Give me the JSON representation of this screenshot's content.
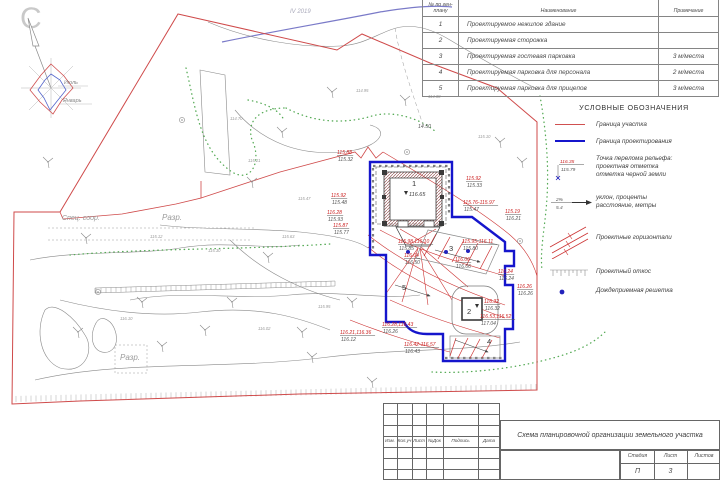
{
  "compass": {
    "north": "С",
    "july": "Июль",
    "january": "Январь"
  },
  "survey_note": "IV 2019",
  "table": {
    "headers": {
      "num": "№ по ген-плану",
      "name": "Наименование",
      "note": "Примечание"
    },
    "rows": [
      {
        "num": "1",
        "name": "Проектируемое нежилое здание",
        "note": ""
      },
      {
        "num": "2",
        "name": "Проектируемая сторожка",
        "note": ""
      },
      {
        "num": "3",
        "name": "Проектируемая гостевая парковка",
        "note": "3 м/места"
      },
      {
        "num": "4",
        "name": "Проектируемая парковка для персонала",
        "note": "2 м/места"
      },
      {
        "num": "5",
        "name": "Проектируемая парковка для прицепов",
        "note": "3 м/места"
      }
    ]
  },
  "legend": {
    "title": "УСЛОВНЫЕ ОБОЗНАЧЕНИЯ",
    "item1": "Граница участка",
    "item2": "Граница проектирования",
    "item3a": "Точка перелома рельефа:",
    "item3b": "проектная отметка",
    "item3c": "отметка черной земли",
    "item3red": "116.35",
    "item3black": "115.79",
    "item4a": "уклон, проценты",
    "item4b": "расстояние, метры",
    "item4top": "2%",
    "item4bottom": "5.4",
    "item5": "Проектные горизонтали",
    "item6": "Проектный откос",
    "item7": "Дождеприемная решетка"
  },
  "titleblock": {
    "title": "Схема планировочной организации земельного участка",
    "cols": [
      "Изм.",
      "Кол.уч",
      "Лист",
      "№Док",
      "Подпись",
      "Дата"
    ],
    "stage_label": "Стадия",
    "sheet_label": "Лист",
    "sheets_label": "Листов",
    "stage": "П",
    "sheet": "3",
    "sheets": ""
  },
  "plan": {
    "building1": {
      "num": "1",
      "elev": "116.65"
    },
    "building2": {
      "num": "2"
    },
    "spec_soor": "Спец. соор.",
    "razr1": "Разр.",
    "razr2": "Разр.",
    "dim_note": "14.50",
    "areas": [
      {
        "n": "1",
        "x": 412,
        "y": 186
      },
      {
        "n": "2",
        "x": 467,
        "y": 314
      },
      {
        "n": "3",
        "x": 449,
        "y": 251
      },
      {
        "n": "4",
        "x": 487,
        "y": 344
      },
      {
        "n": "5",
        "x": 402,
        "y": 290
      }
    ],
    "marks": [
      {
        "x": 337,
        "y": 154,
        "r": "115.88",
        "b": "115.32"
      },
      {
        "x": 331,
        "y": 197,
        "r": "115.92",
        "b": "115.48"
      },
      {
        "x": 327,
        "y": 214,
        "r": "116.28",
        "b": "115.93"
      },
      {
        "x": 333,
        "y": 227,
        "r": "115.87",
        "b": "115.77"
      },
      {
        "x": 466,
        "y": 180,
        "r": "115.92",
        "b": "115.33"
      },
      {
        "x": 463,
        "y": 204,
        "r": "115.76-115.97",
        "b": "115.47"
      },
      {
        "x": 505,
        "y": 213,
        "r": "115.19",
        "b": "116.21"
      },
      {
        "x": 462,
        "y": 243,
        "r": "115.95-116.11",
        "b": "115.80"
      },
      {
        "x": 455,
        "y": 261,
        "r": "116.06",
        "b": "116.06"
      },
      {
        "x": 498,
        "y": 273,
        "r": "116.24",
        "b": "116.24"
      },
      {
        "x": 517,
        "y": 288,
        "r": "116.26",
        "b": "116.26"
      },
      {
        "x": 484,
        "y": 303,
        "r": "116.32",
        "b": "116.32"
      },
      {
        "x": 480,
        "y": 318,
        "r": "116.53,116.52",
        "b": "117.04"
      },
      {
        "x": 398,
        "y": 243,
        "r": "115.98,116.10",
        "b": "115.85"
      },
      {
        "x": 404,
        "y": 257,
        "r": "116.04",
        "b": "116.50"
      },
      {
        "x": 382,
        "y": 326,
        "r": "116.28,116.43",
        "b": "116.26"
      },
      {
        "x": 340,
        "y": 334,
        "r": "116.21,116.36",
        "b": "116.12"
      },
      {
        "x": 404,
        "y": 346,
        "r": "116.42-116.57",
        "b": "116.43"
      }
    ],
    "points": [
      {
        "x": 248,
        "y": 162,
        "v": "115.21"
      },
      {
        "x": 298,
        "y": 200,
        "v": "115.47"
      },
      {
        "x": 282,
        "y": 238,
        "v": "115.63"
      },
      {
        "x": 208,
        "y": 252,
        "v": "115.30"
      },
      {
        "x": 150,
        "y": 238,
        "v": "115.12"
      },
      {
        "x": 318,
        "y": 308,
        "v": "115.95"
      },
      {
        "x": 258,
        "y": 330,
        "v": "116.02"
      },
      {
        "x": 478,
        "y": 138,
        "v": "115.10"
      },
      {
        "x": 428,
        "y": 98,
        "v": "114.88"
      },
      {
        "x": 356,
        "y": 92,
        "v": "114.95"
      },
      {
        "x": 230,
        "y": 120,
        "v": "114.70"
      },
      {
        "x": 120,
        "y": 320,
        "v": "116.10"
      }
    ]
  },
  "colors": {
    "boundary_red": "#cf4a4a",
    "design_blue": "#1515cc",
    "mark_red": "#cc2222",
    "contour_gray": "#8a8a8a",
    "veg_green": "#55aa55"
  }
}
